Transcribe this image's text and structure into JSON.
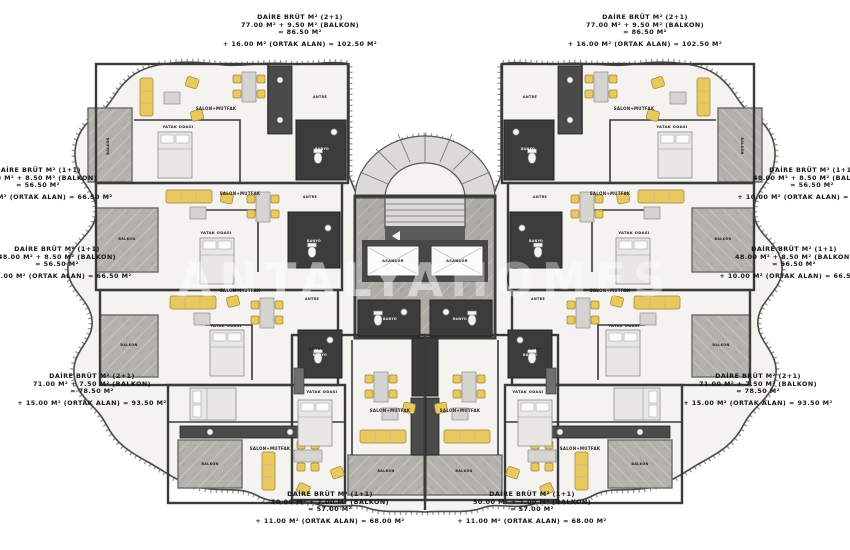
{
  "colors": {
    "furniture_yellow": "#e9c95f",
    "balcony_gray": "#b5b2ad",
    "wall_dark": "#3a3a3a",
    "floor_light": "#f4f3f0",
    "text": "#161616"
  },
  "watermark": {
    "part1": "ANTALYA",
    "part2": "HOMES"
  },
  "core": {
    "elevator_label": "ASANSÖR"
  },
  "annotations": [
    {
      "id": "top_left",
      "lines": [
        "DAİRE BRÜT M² (2+1)",
        "77.00 M² + 9.50 M² (BALKON)",
        "= 86.50 M²",
        "+ 16.00 M² (ORTAK ALAN) = 102.50 M²"
      ]
    },
    {
      "id": "top_right",
      "lines": [
        "DAİRE BRÜT M² (2+1)",
        "77.00 M² + 9.50 M² (BALKON)",
        "= 86.50 M²",
        "+ 16.00 M² (ORTAK ALAN) = 102.50 M²"
      ]
    },
    {
      "id": "left_upper",
      "lines": [
        "DAİRE BRÜT M² (1+1)",
        "48.00 M² + 8.50 M² (BALKON)",
        "= 56.50 M²",
        "+ 10.00 M² (ORTAK ALAN) = 66.50 M²"
      ]
    },
    {
      "id": "left_lower",
      "lines": [
        "DAİRE BRÜT M² (1+1)",
        "48.00 M² + 8.50 M² (BALKON)",
        "= 56.50 M²",
        "+ 10.00 M² (ORTAK ALAN) = 66.50 M²"
      ]
    },
    {
      "id": "bottom_left",
      "lines": [
        "DAİRE BRÜT M² (2+1)",
        "71.00 M² + 7.50 M² (BALKON)",
        "= 78.50 M²",
        "+ 15.00 M² (ORTAK ALAN) = 93.50 M²"
      ]
    },
    {
      "id": "bottom_center_left",
      "lines": [
        "DAİRE BRÜT M² (1+1)",
        "50.00 M² + 7.00 M² (BALKON)",
        "= 57.00 M²",
        "+ 11.00 M² (ORTAK ALAN) = 68.00 M²"
      ]
    },
    {
      "id": "bottom_center_right",
      "lines": [
        "DAİRE BRÜT M² (1+1)",
        "50.00 M² + 7.00 M² (BALKON)",
        "= 57.00 M²",
        "+ 11.00 M² (ORTAK ALAN) = 68.00 M²"
      ]
    },
    {
      "id": "right_upper",
      "lines": [
        "DAİRE BRÜT M² (1+1)",
        "48.00 M² + 8.50 M² (BALKON)",
        "= 56.50 M²",
        "+ 10.00 M² (ORTAK ALAN) = 66.50 M²"
      ]
    },
    {
      "id": "right_lower",
      "lines": [
        "DAİRE BRÜT M² (1+1)",
        "48.00 M² + 8.50 M² (BALKON)",
        "= 56.50 M²",
        "+ 10.00 M² (ORTAK ALAN) = 66.50 M²"
      ]
    },
    {
      "id": "bottom_right",
      "lines": [
        "DAİRE BRÜT M² (2+1)",
        "71.00 M² + 7.50 M² (BALKON)",
        "= 78.50 M²",
        "+ 15.00 M² (ORTAK ALAN) = 93.50 M²"
      ]
    }
  ],
  "room_labels": [
    {
      "t": "SALON+MUTFAK",
      "x": 216,
      "y": 110,
      "s": 4,
      "c": "dark"
    },
    {
      "t": "YATAK ODASI",
      "x": 178,
      "y": 128,
      "s": 3.8,
      "c": "dark"
    },
    {
      "t": "BALKON",
      "x": 109,
      "y": 146,
      "s": 3.4,
      "c": "dark",
      "r": -90
    },
    {
      "t": "BANYO",
      "x": 322,
      "y": 150,
      "s": 3.2,
      "c": "light"
    },
    {
      "t": "ANTRE",
      "x": 320,
      "y": 98,
      "s": 3.4,
      "c": "dark"
    },
    {
      "t": "SALON+MUTFAK",
      "x": 634,
      "y": 110,
      "s": 4,
      "c": "dark"
    },
    {
      "t": "YATAK ODASI",
      "x": 672,
      "y": 128,
      "s": 3.8,
      "c": "dark"
    },
    {
      "t": "BALKON",
      "x": 741,
      "y": 146,
      "s": 3.4,
      "c": "dark",
      "r": 90
    },
    {
      "t": "BANYO",
      "x": 528,
      "y": 150,
      "s": 3.2,
      "c": "light"
    },
    {
      "t": "ANTRE",
      "x": 530,
      "y": 98,
      "s": 3.4,
      "c": "dark"
    },
    {
      "t": "SALON+MUTFAK",
      "x": 240,
      "y": 195,
      "s": 4,
      "c": "dark"
    },
    {
      "t": "YATAK ODASI",
      "x": 216,
      "y": 234,
      "s": 3.8,
      "c": "dark"
    },
    {
      "t": "BALKON",
      "x": 127,
      "y": 240,
      "s": 3.4,
      "c": "dark"
    },
    {
      "t": "BANYO",
      "x": 314,
      "y": 242,
      "s": 3.2,
      "c": "light"
    },
    {
      "t": "ANTRE",
      "x": 310,
      "y": 198,
      "s": 3.4,
      "c": "dark"
    },
    {
      "t": "SALON+MUTFAK",
      "x": 610,
      "y": 195,
      "s": 4,
      "c": "dark"
    },
    {
      "t": "YATAK ODASI",
      "x": 634,
      "y": 234,
      "s": 3.8,
      "c": "dark"
    },
    {
      "t": "BALKON",
      "x": 723,
      "y": 240,
      "s": 3.4,
      "c": "dark"
    },
    {
      "t": "BANYO",
      "x": 536,
      "y": 242,
      "s": 3.2,
      "c": "light"
    },
    {
      "t": "ANTRE",
      "x": 540,
      "y": 198,
      "s": 3.4,
      "c": "dark"
    },
    {
      "t": "SALON+MUTFAK",
      "x": 240,
      "y": 292,
      "s": 4,
      "c": "dark"
    },
    {
      "t": "YATAK ODASI",
      "x": 226,
      "y": 327,
      "s": 3.8,
      "c": "dark"
    },
    {
      "t": "BALKON",
      "x": 129,
      "y": 346,
      "s": 3.4,
      "c": "dark"
    },
    {
      "t": "BANYO",
      "x": 320,
      "y": 356,
      "s": 3.2,
      "c": "light"
    },
    {
      "t": "ANTRE",
      "x": 312,
      "y": 300,
      "s": 3.4,
      "c": "dark"
    },
    {
      "t": "SALON+MUTFAK",
      "x": 610,
      "y": 292,
      "s": 4,
      "c": "dark"
    },
    {
      "t": "YATAK ODASI",
      "x": 624,
      "y": 327,
      "s": 3.8,
      "c": "dark"
    },
    {
      "t": "BALKON",
      "x": 721,
      "y": 346,
      "s": 3.4,
      "c": "dark"
    },
    {
      "t": "BANYO",
      "x": 530,
      "y": 356,
      "s": 3.2,
      "c": "light"
    },
    {
      "t": "ANTRE",
      "x": 538,
      "y": 300,
      "s": 3.4,
      "c": "dark"
    },
    {
      "t": "SALON+MUTFAK",
      "x": 270,
      "y": 450,
      "s": 4,
      "c": "dark"
    },
    {
      "t": "BALKON",
      "x": 210,
      "y": 465,
      "s": 3.4,
      "c": "dark"
    },
    {
      "t": "SALON+MUTFAK",
      "x": 580,
      "y": 450,
      "s": 4,
      "c": "dark"
    },
    {
      "t": "BALKON",
      "x": 640,
      "y": 465,
      "s": 3.4,
      "c": "dark"
    },
    {
      "t": "YATAK ODASI",
      "x": 322,
      "y": 393,
      "s": 3.8,
      "c": "dark"
    },
    {
      "t": "SALON+MUTFAK",
      "x": 390,
      "y": 412,
      "s": 4,
      "c": "dark"
    },
    {
      "t": "BALKON",
      "x": 386,
      "y": 472,
      "s": 3.4,
      "c": "dark"
    },
    {
      "t": "BANYO",
      "x": 390,
      "y": 320,
      "s": 3.2,
      "c": "light"
    },
    {
      "t": "ANTRE",
      "x": 316,
      "y": 350,
      "s": 3.4,
      "c": "dark"
    },
    {
      "t": "YATAK ODASI",
      "x": 528,
      "y": 393,
      "s": 3.8,
      "c": "dark"
    },
    {
      "t": "SALON+MUTFAK",
      "x": 460,
      "y": 412,
      "s": 4,
      "c": "dark"
    },
    {
      "t": "BALKON",
      "x": 464,
      "y": 472,
      "s": 3.4,
      "c": "dark"
    },
    {
      "t": "BANYO",
      "x": 460,
      "y": 320,
      "s": 3.2,
      "c": "light"
    },
    {
      "t": "ANTRE",
      "x": 534,
      "y": 350,
      "s": 3.4,
      "c": "dark"
    },
    {
      "t": "ASANSÖR",
      "x": 393,
      "y": 262,
      "s": 3.6,
      "c": "dark"
    },
    {
      "t": "ASANSÖR",
      "x": 457,
      "y": 262,
      "s": 3.6,
      "c": "dark"
    }
  ]
}
